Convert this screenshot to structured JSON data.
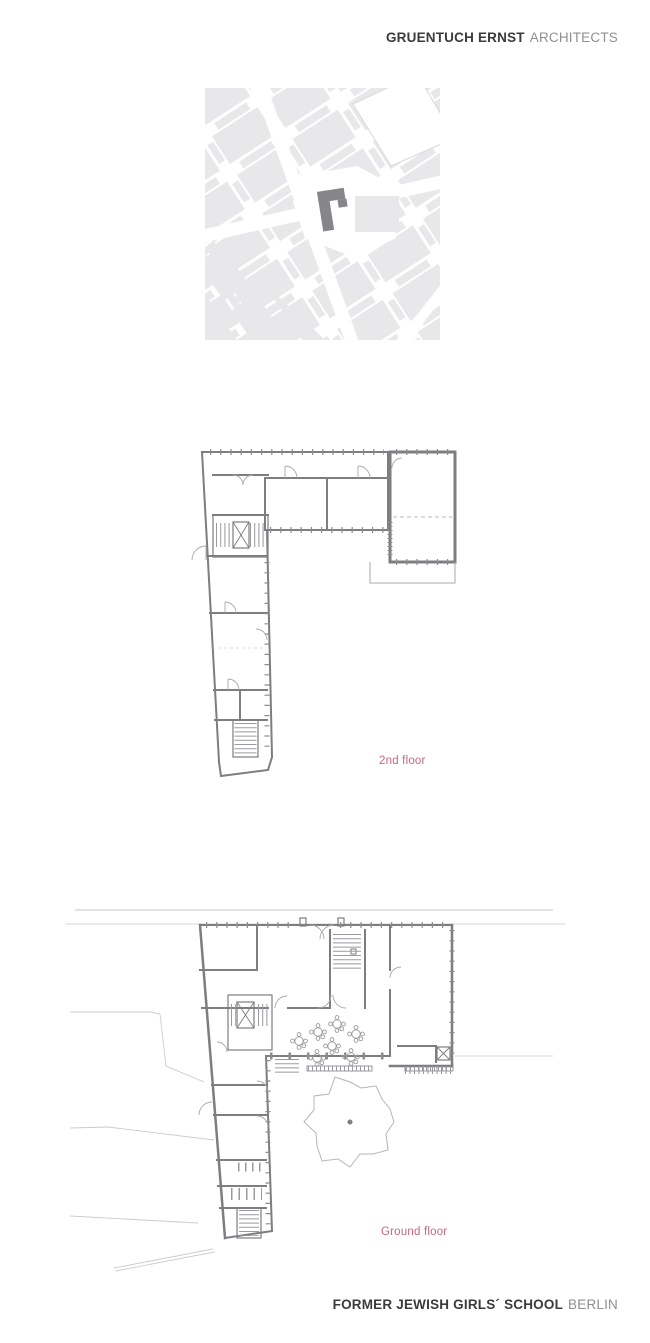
{
  "header": {
    "firm_name": "GRUENTUCH ERNST",
    "firm_suffix": "ARCHITECTS"
  },
  "footer": {
    "project_name": "FORMER JEWISH GIRLS´ SCHOOL",
    "project_location": "BERLIN"
  },
  "plans": [
    {
      "id": "second-floor",
      "label": "2nd floor"
    },
    {
      "id": "ground-floor",
      "label": "Ground floor"
    }
  ],
  "site_map": {
    "description": "city site map with highlighted L-shaped building"
  },
  "icons": {
    "site_map": "site-location-map",
    "highlight": "highlighted-building",
    "tree": "courtyard-tree",
    "table": "cafe-table",
    "elevator": "elevator-shaft",
    "stairs": "staircase"
  },
  "colors": {
    "background": "#ffffff",
    "brand_dark": "#3b3b3d",
    "brand_light": "#8f8f93",
    "accent_pink": "#c5697d",
    "wall_gray": "#7d7d82",
    "thin_gray": "#a8a8ad",
    "tick_gray": "#8b8b90",
    "comb_gray": "#9a9aa0",
    "context_gray": "#cccccf",
    "map_block": "#e8e8eb",
    "map_highlight": "#85858a",
    "tree_gray": "#b5b5ba"
  }
}
